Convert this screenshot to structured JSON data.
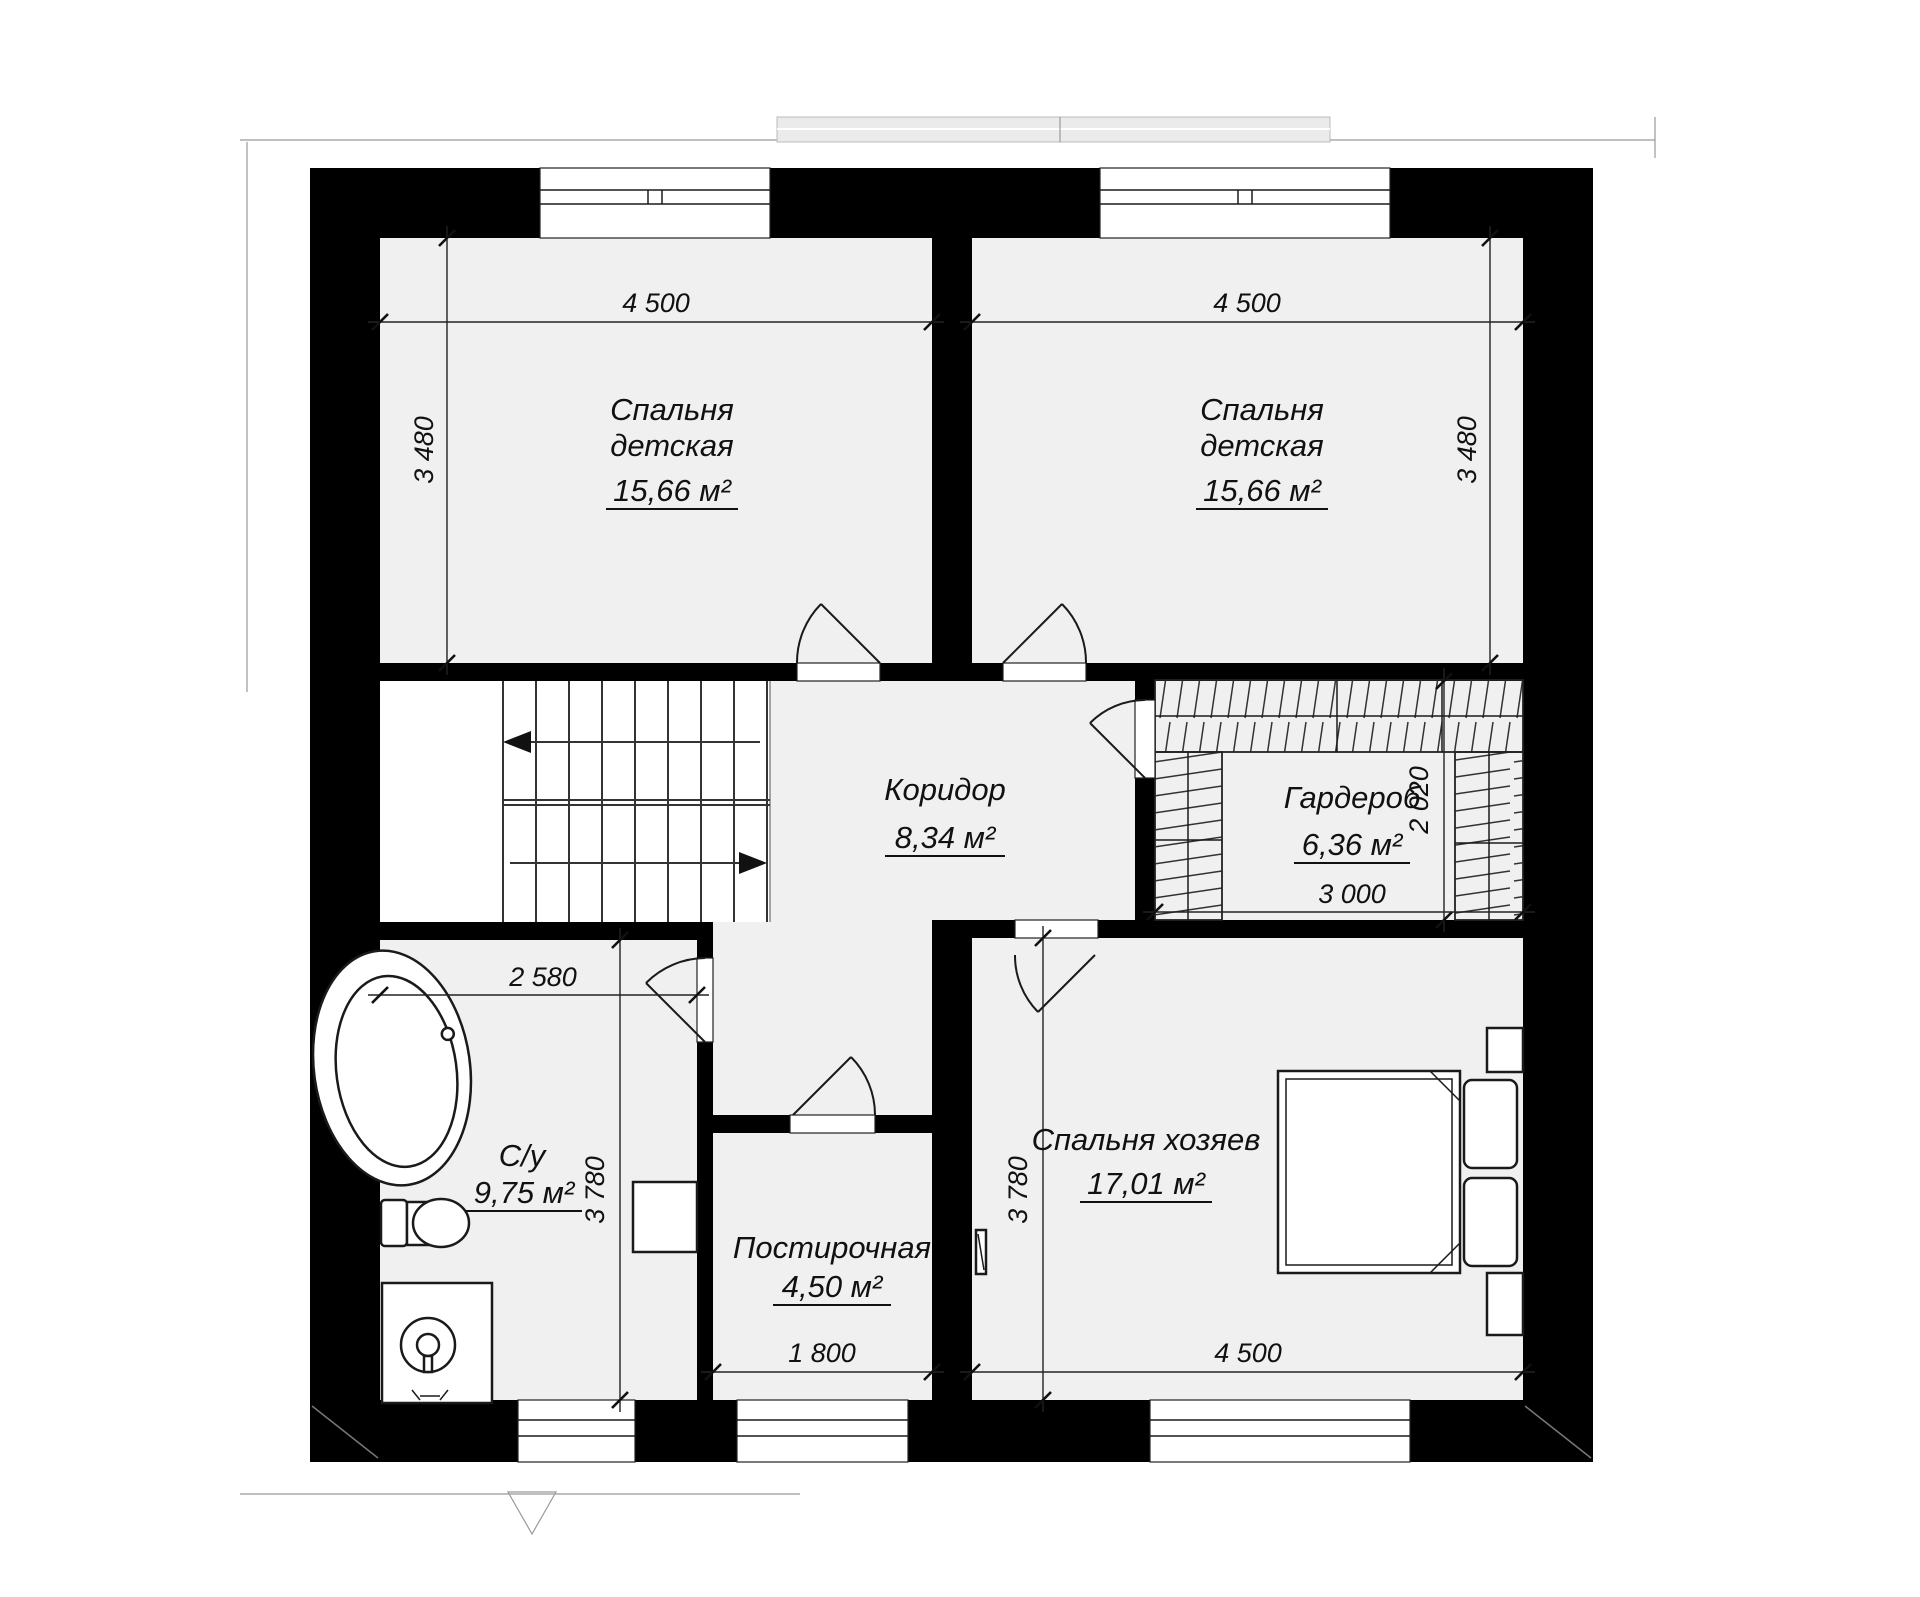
{
  "rooms": {
    "bedroom_left": {
      "line1": "Спальня",
      "line2": "детская",
      "area": "15,66 м²"
    },
    "bedroom_right": {
      "line1": "Спальня",
      "line2": "детская",
      "area": "15,66 м²"
    },
    "corridor": {
      "name": "Коридор",
      "area": "8,34 м²"
    },
    "wardrobe": {
      "name": "Гардероб",
      "area": "6,36 м²"
    },
    "bathroom": {
      "name": "С/у",
      "area": "9,75 м²"
    },
    "laundry": {
      "name": "Постирочная",
      "area": "4,50 м²"
    },
    "master_bedroom": {
      "name": "Спальня хозяев",
      "area": "17,01 м²"
    }
  },
  "dimensions": {
    "bedroom_left_width": "4 500",
    "bedroom_right_width": "4 500",
    "bedroom_left_depth": "3 480",
    "bedroom_right_depth": "3 480",
    "wardrobe_depth": "2 020",
    "wardrobe_width": "3 000",
    "bathroom_width": "2 580",
    "bathroom_depth": "3 780",
    "master_depth": "3 780",
    "laundry_width": "1 800",
    "master_width": "4 500"
  },
  "colors": {
    "wall": "#000000",
    "floor": "#f0f0f0",
    "fixture": "#ffffff",
    "line": "#1a1a1a"
  }
}
